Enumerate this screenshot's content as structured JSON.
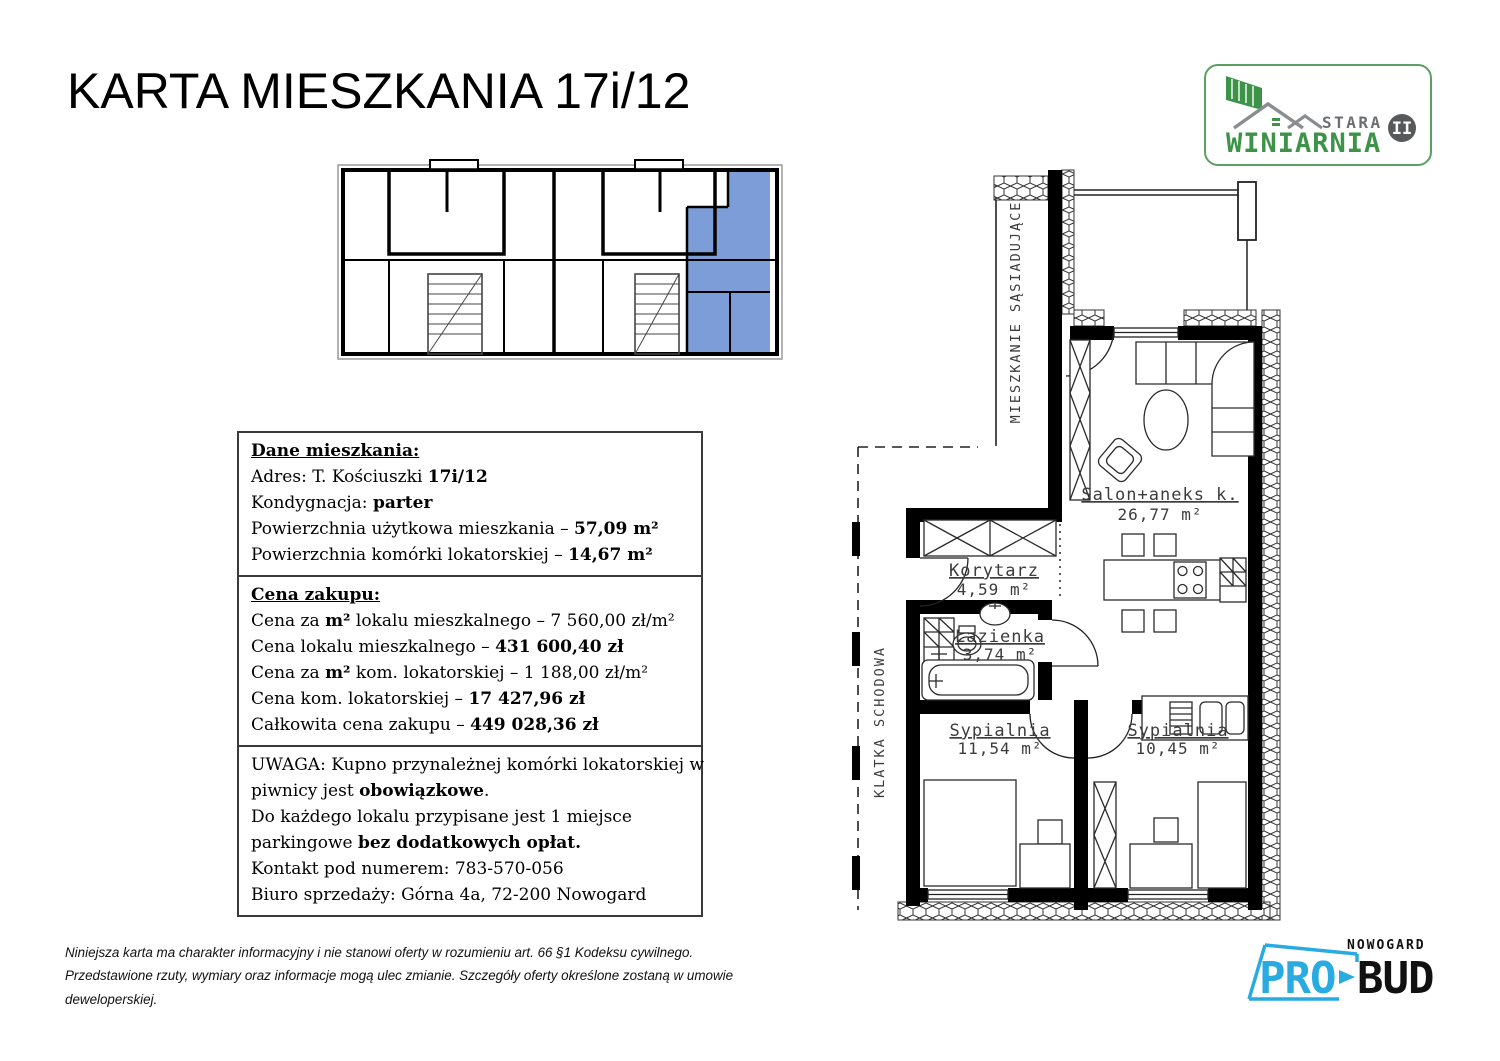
{
  "page": {
    "title": "KARTA MIESZKANIA 17i/12"
  },
  "brand": {
    "stara": "STARA",
    "winiarnia": "WINIARNIA",
    "numeral": "II"
  },
  "colors": {
    "highlight_blue": "#7d9dd9",
    "brand_green": "#3d9348",
    "brand_gray": "#6d6e71",
    "probud_blue": "#29abe2"
  },
  "boxes": [
    {
      "name": "dane-mieszkania",
      "lines": [
        {
          "segments": [
            {
              "text": "Dane mieszkania:",
              "bold": true,
              "underline": true
            }
          ]
        },
        {
          "segments": [
            {
              "text": "Adres: T. Kościuszki "
            },
            {
              "text": "17i/12",
              "bold": true
            }
          ]
        },
        {
          "segments": [
            {
              "text": "Kondygnacja: "
            },
            {
              "text": "parter",
              "bold": true
            }
          ]
        },
        {
          "segments": [
            {
              "text": "Powierzchnia użytkowa mieszkania – "
            },
            {
              "text": "57,09 m²",
              "bold": true
            }
          ]
        },
        {
          "segments": [
            {
              "text": "Powierzchnia komórki lokatorskiej – "
            },
            {
              "text": "14,67 m²",
              "bold": true
            }
          ]
        }
      ]
    },
    {
      "name": "cena-zakupu",
      "lines": [
        {
          "segments": [
            {
              "text": "Cena zakupu:",
              "bold": true,
              "underline": true
            }
          ]
        },
        {
          "segments": [
            {
              "text": "Cena za "
            },
            {
              "text": "m²",
              "bold": true
            },
            {
              "text": " lokalu mieszkalnego – 7 560,00 zł/m²"
            }
          ]
        },
        {
          "segments": [
            {
              "text": "Cena lokalu mieszkalnego – "
            },
            {
              "text": "431 600,40 zł",
              "bold": true
            }
          ]
        },
        {
          "segments": [
            {
              "text": "Cena za "
            },
            {
              "text": "m²",
              "bold": true
            },
            {
              "text": " kom. lokatorskiej – 1 188,00 zł/m²"
            }
          ]
        },
        {
          "segments": [
            {
              "text": "Cena kom. lokatorskiej – "
            },
            {
              "text": "17 427,96 zł",
              "bold": true
            }
          ]
        },
        {
          "segments": [
            {
              "text": "Całkowita cena zakupu – "
            },
            {
              "text": "449 028,36 zł",
              "bold": true
            }
          ]
        }
      ]
    },
    {
      "name": "uwaga",
      "lines": [
        {
          "segments": [
            {
              "text": "UWAGA: Kupno przynależnej komórki lokatorskiej w"
            }
          ]
        },
        {
          "segments": [
            {
              "text": "piwnicy jest "
            },
            {
              "text": "obowiązkowe",
              "bold": true
            },
            {
              "text": "."
            }
          ]
        },
        {
          "segments": [
            {
              "text": "Do każdego lokalu przypisane jest 1 miejsce"
            }
          ]
        },
        {
          "segments": [
            {
              "text": "parkingowe "
            },
            {
              "text": "bez dodatkowych opłat.",
              "bold": true
            }
          ]
        },
        {
          "segments": [
            {
              "text": "Kontakt pod numerem: 783-570-056"
            }
          ]
        },
        {
          "segments": [
            {
              "text": "Biuro sprzedaży: Górna 4a, 72-200 Nowogard"
            }
          ]
        }
      ]
    }
  ],
  "floorplan": {
    "rooms": [
      {
        "name": "Salon+aneks k.",
        "area": "26,77 m²"
      },
      {
        "name": "Korytarz",
        "area": "4,59 m²"
      },
      {
        "name": "Łazienka",
        "area": "3,74 m²"
      },
      {
        "name": "Sypialnia",
        "area": "11,54 m²"
      },
      {
        "name": "Sypialnia",
        "area": "10,45 m²"
      }
    ],
    "neighbor_label": "MIESZKANIE SĄSIADUJĄCE",
    "staircase_label": "KLATKA SCHODOWA"
  },
  "footer": {
    "disclaimer": "Niniejsza karta ma charakter informacyjny i nie stanowi oferty w rozumieniu art. 66 §1 Kodeksu cywilnego. Przedstawione rzuty, wymiary oraz informacje mogą ulec zmianie. Szczegóły oferty określone zostaną w umowie deweloperskiej."
  },
  "probud": {
    "nowogard": "NOWOGARD",
    "pro": "PRO",
    "bud": "BUD"
  }
}
